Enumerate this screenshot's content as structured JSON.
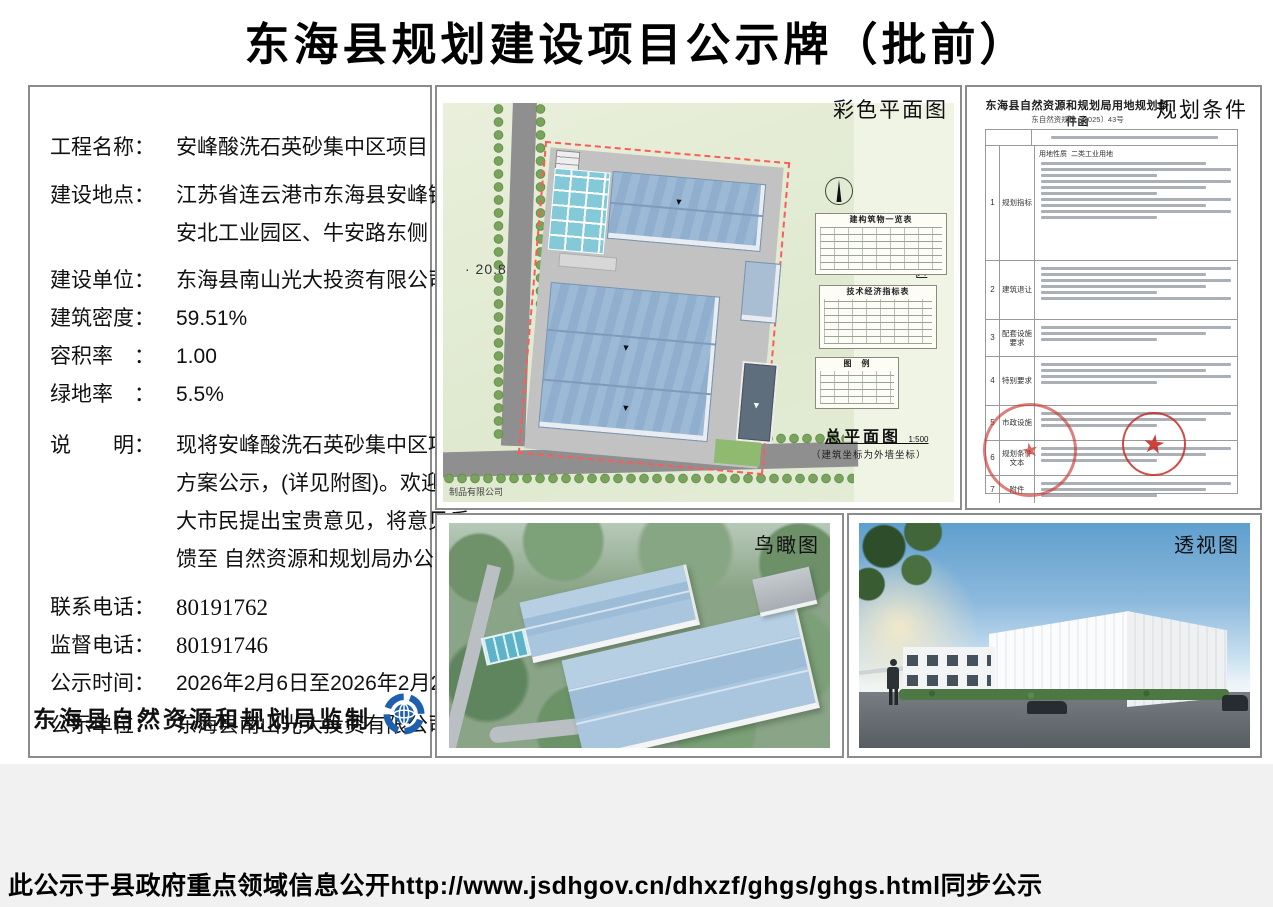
{
  "page": {
    "title": "东海县规划建设项目公示牌（批前）",
    "footer": "此公示于县政府重点领域信息公开http://www.jsdhgov.cn/dhxzf/ghgs/ghgs.html同步公示"
  },
  "info": {
    "f1_label": "工程名称：",
    "f1_value": "安峰酸洗石英砂集中区项目",
    "f2_label": "建设地点：",
    "f2_value1": "江苏省连云港市东海县安峰镇",
    "f2_value2": "安北工业园区、牛安路东侧",
    "f3_label": "建设单位：",
    "f3_value": "东海县南山光大投资有限公司",
    "f4_label": "建筑密度：",
    "f4_value": "59.51%",
    "f5_label": "容积率　：",
    "f5_value": "1.00",
    "f6_label": "绿地率　：",
    "f6_value": "5.5%",
    "note_label": "说　　明：",
    "note_line1": "现将安峰酸洗石英砂集中区项目",
    "note_line2": "方案公示，(详见附图)。欢迎广",
    "note_line3": "大市民提出宝贵意见，将意见反",
    "note_line4": "馈至 自然资源和规划局办公室。",
    "c1_label": "联系电话：",
    "c1_value": "80191762",
    "c2_label": "监督电话：",
    "c2_value": "80191746",
    "c3_label": "公示时间：",
    "c3_value": "2026年2月6日至2026年2月24日",
    "c4_label": "公示单位：",
    "c4_value": "东海县南山光大投资有限公司",
    "producer": "东海县自然资源和规划局监制"
  },
  "plan": {
    "panel_label": "彩色平面图",
    "zone_label": "施工区",
    "elevation": "· 20.8",
    "corner_text": "制品有限公司",
    "table1_title": "建构筑物一览表",
    "table2_title": "技术经济指标表",
    "legend_title": "图　例",
    "drawing_title": "总平面图",
    "drawing_scale": "1:500",
    "drawing_note": "（建筑坐标为外墙坐标）"
  },
  "conditions": {
    "panel_label": "规划条件",
    "doc_title": "东海县自然资源和规划局用地规划条件函",
    "doc_number": "东自然资规设〔2025〕43号",
    "land_use_label": "用地性质",
    "land_use_value": "二类工业用地",
    "stamp_star": "★",
    "rows": [
      {
        "num": "1",
        "label": "规划指标"
      },
      {
        "num": "2",
        "label": "建筑退让"
      },
      {
        "num": "3",
        "label": "配套设施要求"
      },
      {
        "num": "4",
        "label": "特别要求"
      },
      {
        "num": "5",
        "label": "市政设施"
      },
      {
        "num": "6",
        "label": "规划条件文本"
      },
      {
        "num": "7",
        "label": "附件"
      }
    ]
  },
  "aerial": {
    "panel_label": "鸟瞰图"
  },
  "perspective": {
    "panel_label": "透视图"
  },
  "colors": {
    "accent_blue": "#1e5fae",
    "stamp_red": "#c63c35",
    "plan_green": "#e8efdc",
    "roof_blue": "#9cb9d6"
  }
}
